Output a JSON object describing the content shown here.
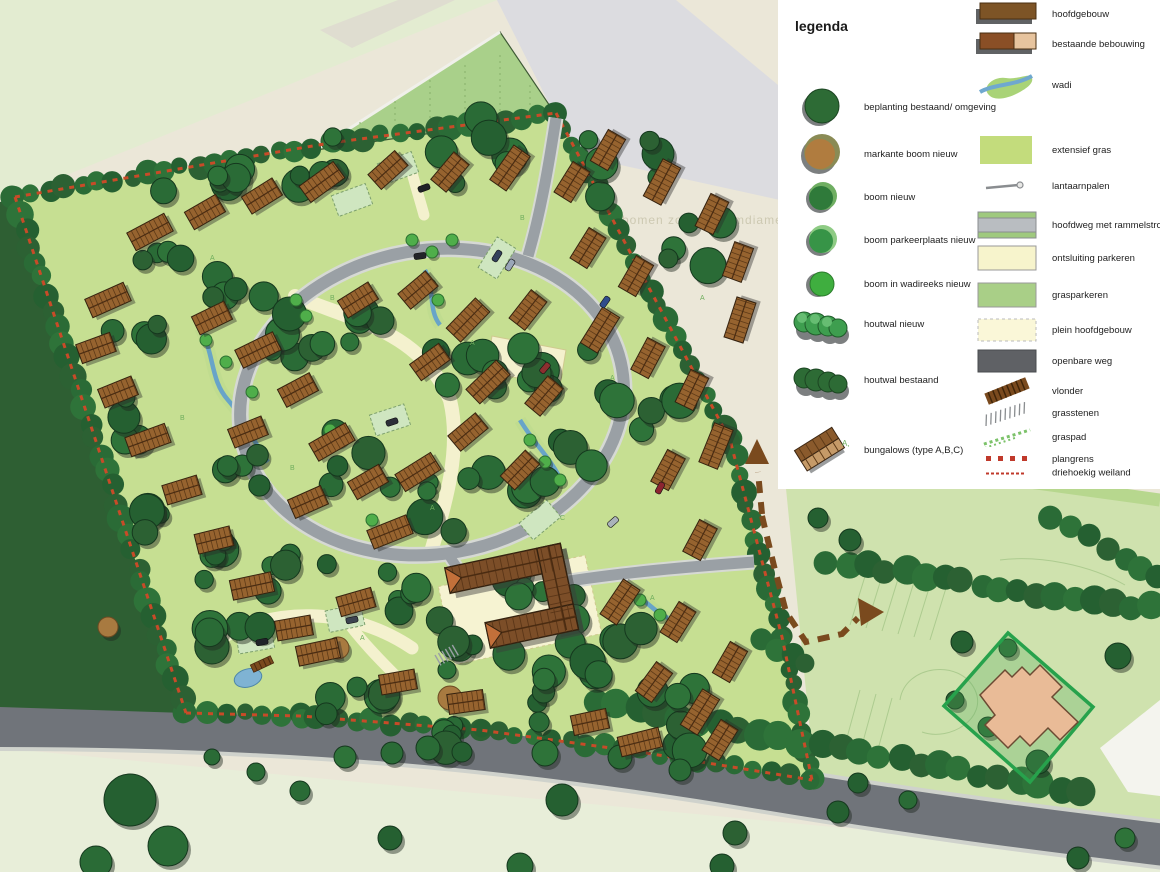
{
  "map": {
    "type": "landscape-masterplan",
    "watermark": "bomen zonder stamdiameter zijn allema",
    "colors": {
      "background_beige": "#ebe7d8",
      "field_pale_green": "#e3ecd1",
      "gray_band": "#dcdce0",
      "site_green": "#c6df92",
      "triangle_meadow": "#a9d08a",
      "forest_dark": "#2e5f33",
      "tree_dark": "#2a6b36",
      "tree_bright": "#4fae4a",
      "tree_notable_brown": "#a87a40",
      "roof_brown": "#96632f",
      "ring_road_gray": "#9aa0a5",
      "public_road_gray": "#70747a",
      "path_cream": "#f4f1ce",
      "wadi_blue": "#68a4c8",
      "plan_boundary_red": "#c84b28",
      "parcel_green": "#cfe2ae",
      "diamond_green": "#27a24c",
      "existing_building_tan": "#e9bb97"
    }
  },
  "legend": {
    "title": "legenda",
    "left_items": [
      {
        "icon": "tree-existing",
        "label": "beplanting bestaand/ omgeving"
      },
      {
        "icon": "tree-notable-new",
        "label": "markante boom nieuw"
      },
      {
        "icon": "tree-new",
        "label": "boom nieuw"
      },
      {
        "icon": "tree-parking-new",
        "label": "boom parkeerplaats nieuw"
      },
      {
        "icon": "tree-wadi-new",
        "label": "boom in wadireeks nieuw"
      },
      {
        "icon": "hedge-new",
        "label": "houtwal nieuw"
      },
      {
        "icon": "hedge-existing",
        "label": "houtwal bestaand"
      },
      {
        "icon": "bungalow",
        "label": "bungalows (type A,B,C)"
      }
    ],
    "right_items": [
      {
        "icon": "main-building",
        "label": "hoofdgebouw"
      },
      {
        "icon": "existing-building",
        "label": "bestaande bebouwing"
      },
      {
        "icon": "wadi",
        "label": "wadi"
      },
      {
        "icon": "extensive-grass",
        "label": "extensief gras"
      },
      {
        "icon": "lamppost",
        "label": "lantaarnpalen"
      },
      {
        "icon": "main-road",
        "label": "hoofdweg met rammelstrook"
      },
      {
        "icon": "parking-access",
        "label": "ontsluiting parkeren"
      },
      {
        "icon": "grass-parking",
        "label": "grasparkeren"
      },
      {
        "icon": "main-square",
        "label": "plein hoofdgebouw"
      },
      {
        "icon": "public-road",
        "label": "openbare weg"
      },
      {
        "icon": "boardwalk",
        "label": "vlonder"
      },
      {
        "icon": "grass-stones",
        "label": "grasstenen"
      },
      {
        "icon": "grass-path",
        "label": "graspad"
      },
      {
        "icon": "plan-boundary",
        "label": "plangrens"
      },
      {
        "icon": "triangular-meadow",
        "label": "driehoekig weiland"
      }
    ]
  }
}
